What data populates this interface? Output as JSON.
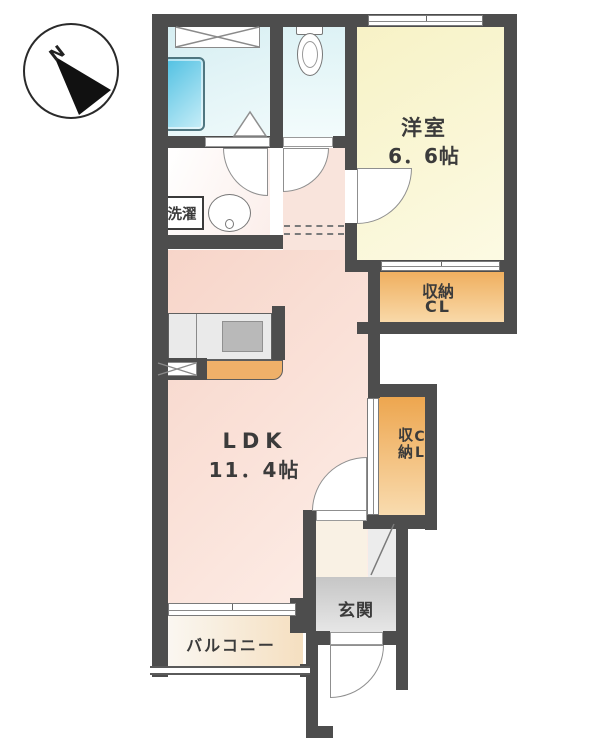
{
  "compass": {
    "north_label": "N"
  },
  "labels": {
    "western_room_name": "洋室",
    "western_room_size": "6．6帖",
    "ldk_name": "LDK",
    "ldk_size": "11．4帖",
    "closet_upper_line1": "収納",
    "closet_upper_line2": "CL",
    "closet_side_line1": "収納",
    "closet_side_line2": "CL",
    "laundry": "洗濯",
    "entrance": "玄関",
    "balcony": "バルコニー"
  },
  "colors": {
    "wall": "#4d4d4d",
    "western_room": "#f9f5cf",
    "closet_orange": "#efa95b",
    "ldk_pink": "#f8dcd1",
    "bath_cyan": "#ddf1f4",
    "bathtub_blue": "#5cc6e5",
    "entrance_gray": "#d0d0d0",
    "balcony_cream": "#f5dfc0",
    "kitchen_counter_gray": "#eaeaea",
    "kitchen_base_orange": "#efb069"
  }
}
